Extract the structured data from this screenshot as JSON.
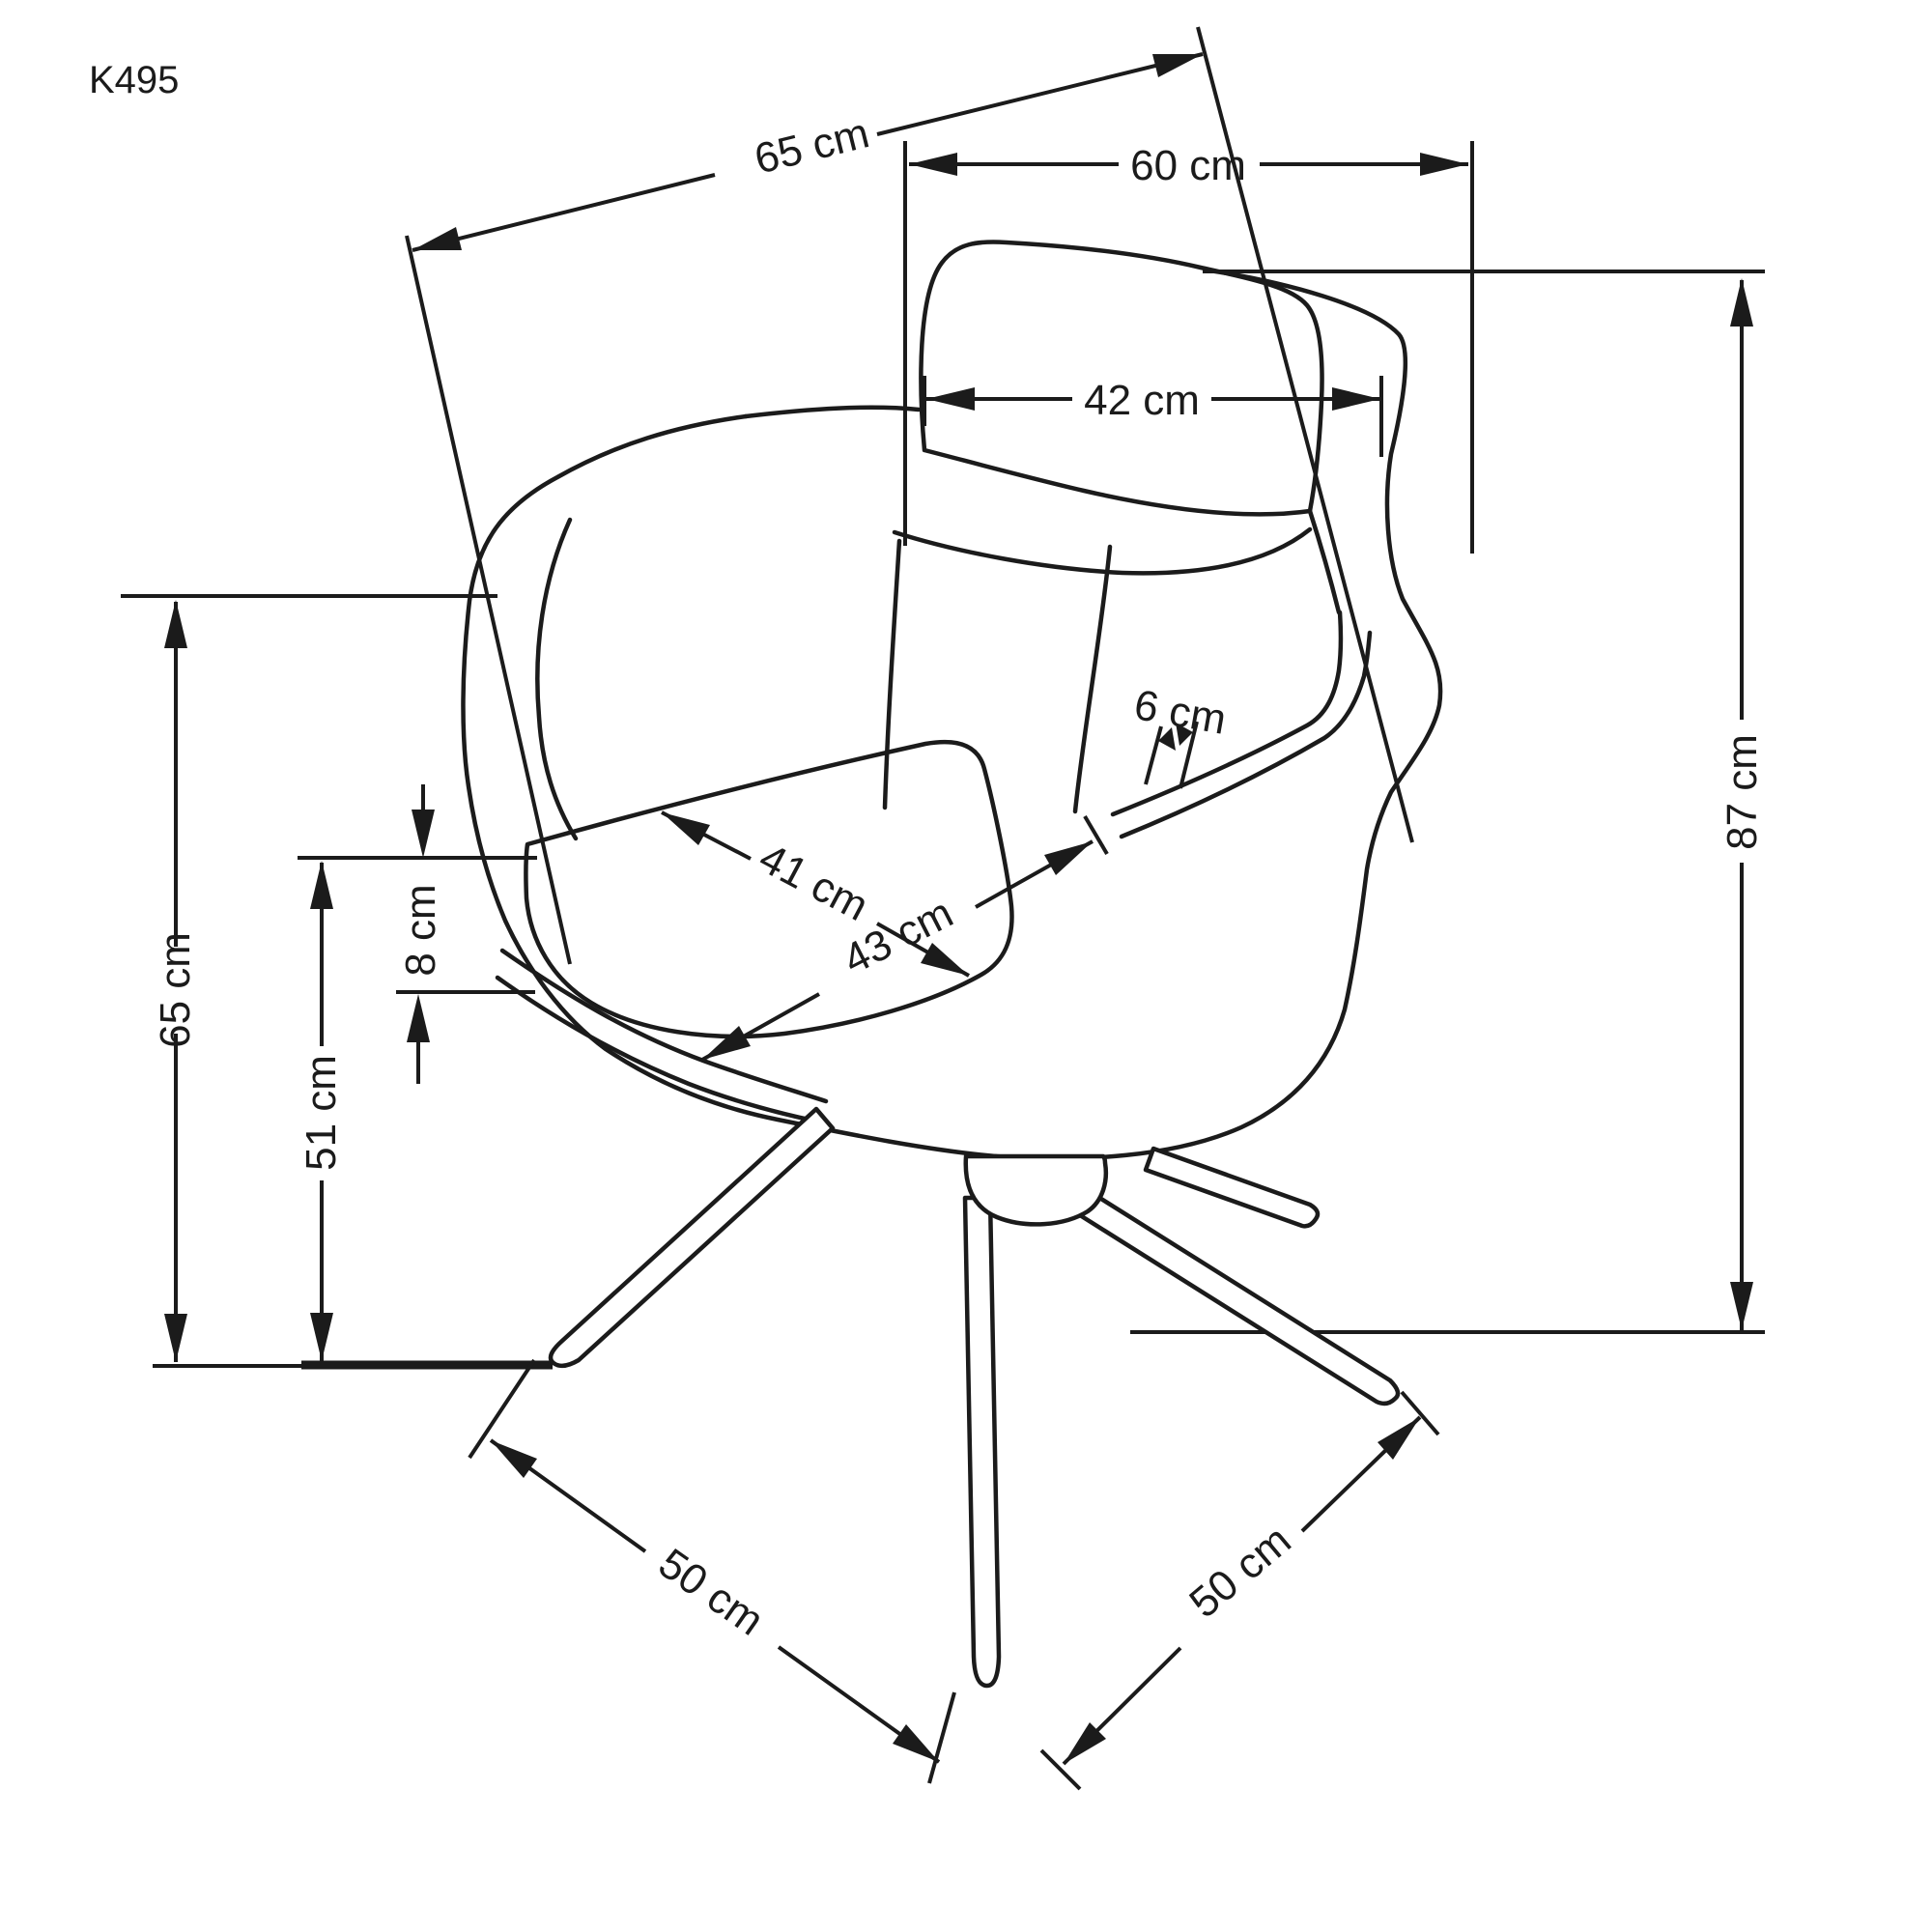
{
  "page": {
    "background": "#ffffff",
    "ink": "#1b1b1b"
  },
  "drawing": {
    "model_code": "K495",
    "subject": "upholstered swivel armchair on four-star metal base, three-quarter line drawing",
    "unit": "cm"
  },
  "dims": {
    "overall_width_diag": {
      "label": "65 cm",
      "value": 65,
      "orientation": "diagonal top"
    },
    "top_width": {
      "label": "60 cm",
      "value": 60,
      "orientation": "horizontal top"
    },
    "backrest_width": {
      "label": "42 cm",
      "value": 42,
      "orientation": "horizontal on backrest"
    },
    "armrest_thickness": {
      "label": "6 cm",
      "value": 6,
      "orientation": "short, right armrest"
    },
    "seat_depth": {
      "label": "41 cm",
      "value": 41,
      "orientation": "diagonal on seat"
    },
    "seat_width": {
      "label": "43 cm",
      "value": 43,
      "orientation": "diagonal on seat"
    },
    "total_height": {
      "label": "87 cm",
      "value": 87,
      "orientation": "vertical right"
    },
    "backrest_height": {
      "label": "65 cm",
      "value": 65,
      "orientation": "vertical left"
    },
    "cushion_thickness": {
      "label": "8 cm",
      "value": 8,
      "orientation": "vertical small left"
    },
    "seat_height": {
      "label": "51 cm",
      "value": 51,
      "orientation": "vertical left"
    },
    "base_span_left": {
      "label": "50 cm",
      "value": 50,
      "orientation": "diagonal bottom-left leg"
    },
    "base_span_right": {
      "label": "50 cm",
      "value": 50,
      "orientation": "diagonal bottom-right leg"
    }
  }
}
